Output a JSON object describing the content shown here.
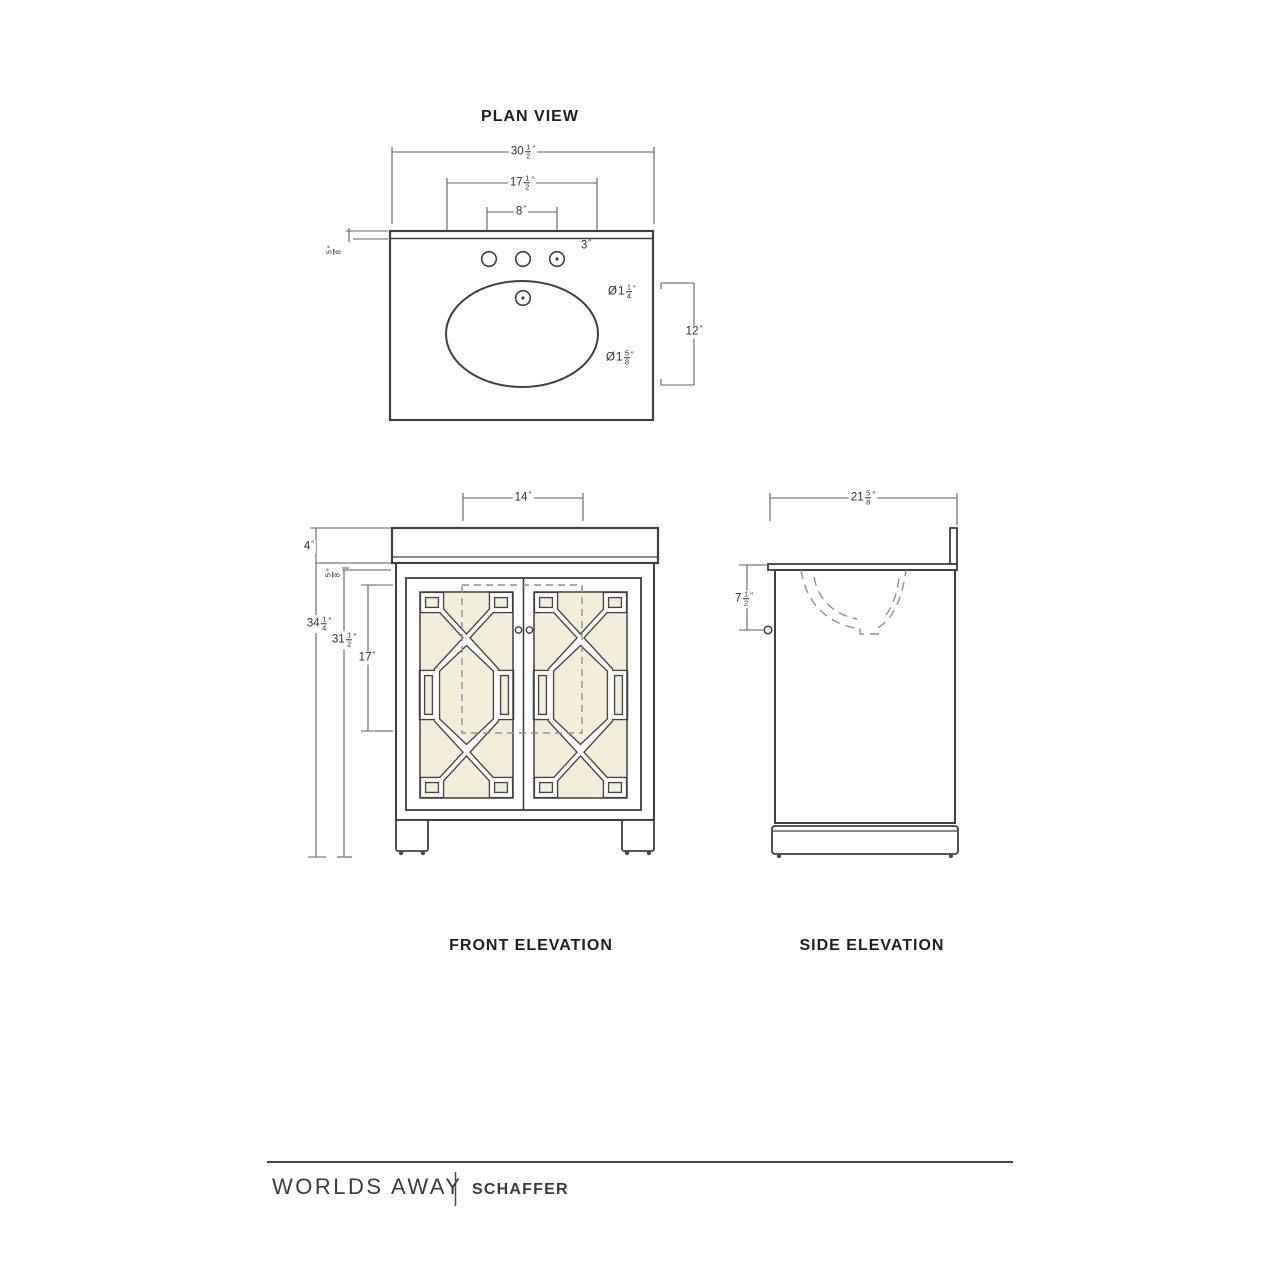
{
  "units": {
    "inch": "″"
  },
  "symbols": {
    "diameter": "Ø"
  },
  "plan": {
    "title": "PLAN VIEW",
    "dims": {
      "overall_width": {
        "whole": "30",
        "num": "1",
        "den": "2"
      },
      "sink_width": {
        "whole": "17",
        "num": "1",
        "den": "2"
      },
      "faucet_spread": {
        "whole": "8"
      },
      "faucet_offset": {
        "whole": "3"
      },
      "faucet_hole_dia": {
        "whole": "1",
        "num": "1",
        "den": "4"
      },
      "sink_depth": {
        "whole": "12"
      },
      "drain_dia": {
        "whole": "1",
        "num": "5",
        "den": "8"
      },
      "top_thickness": {
        "num": "5",
        "den": "8"
      }
    }
  },
  "front": {
    "title": "FRONT ELEVATION",
    "dims": {
      "sink_cutout_width": {
        "whole": "14"
      },
      "backsplash_height": {
        "whole": "4"
      },
      "top_thickness": {
        "num": "5",
        "den": "8"
      },
      "overall_height": {
        "whole": "34",
        "num": "1",
        "den": "4"
      },
      "cabinet_height": {
        "whole": "31",
        "num": "1",
        "den": "2"
      },
      "door_height": {
        "whole": "17"
      }
    }
  },
  "side": {
    "title": "SIDE ELEVATION",
    "dims": {
      "overall_depth": {
        "whole": "21",
        "num": "5",
        "den": "8"
      },
      "bowl_depth": {
        "whole": "7",
        "num": "1",
        "den": "2"
      }
    }
  },
  "footer": {
    "brand": "WORLDS AWAY",
    "product": "SCHAFFER"
  },
  "colors": {
    "line": "#3f3f3f",
    "dimension": "#5f5f5f",
    "door_panel": "#f3eed9",
    "dash": "#8f8f8f"
  }
}
